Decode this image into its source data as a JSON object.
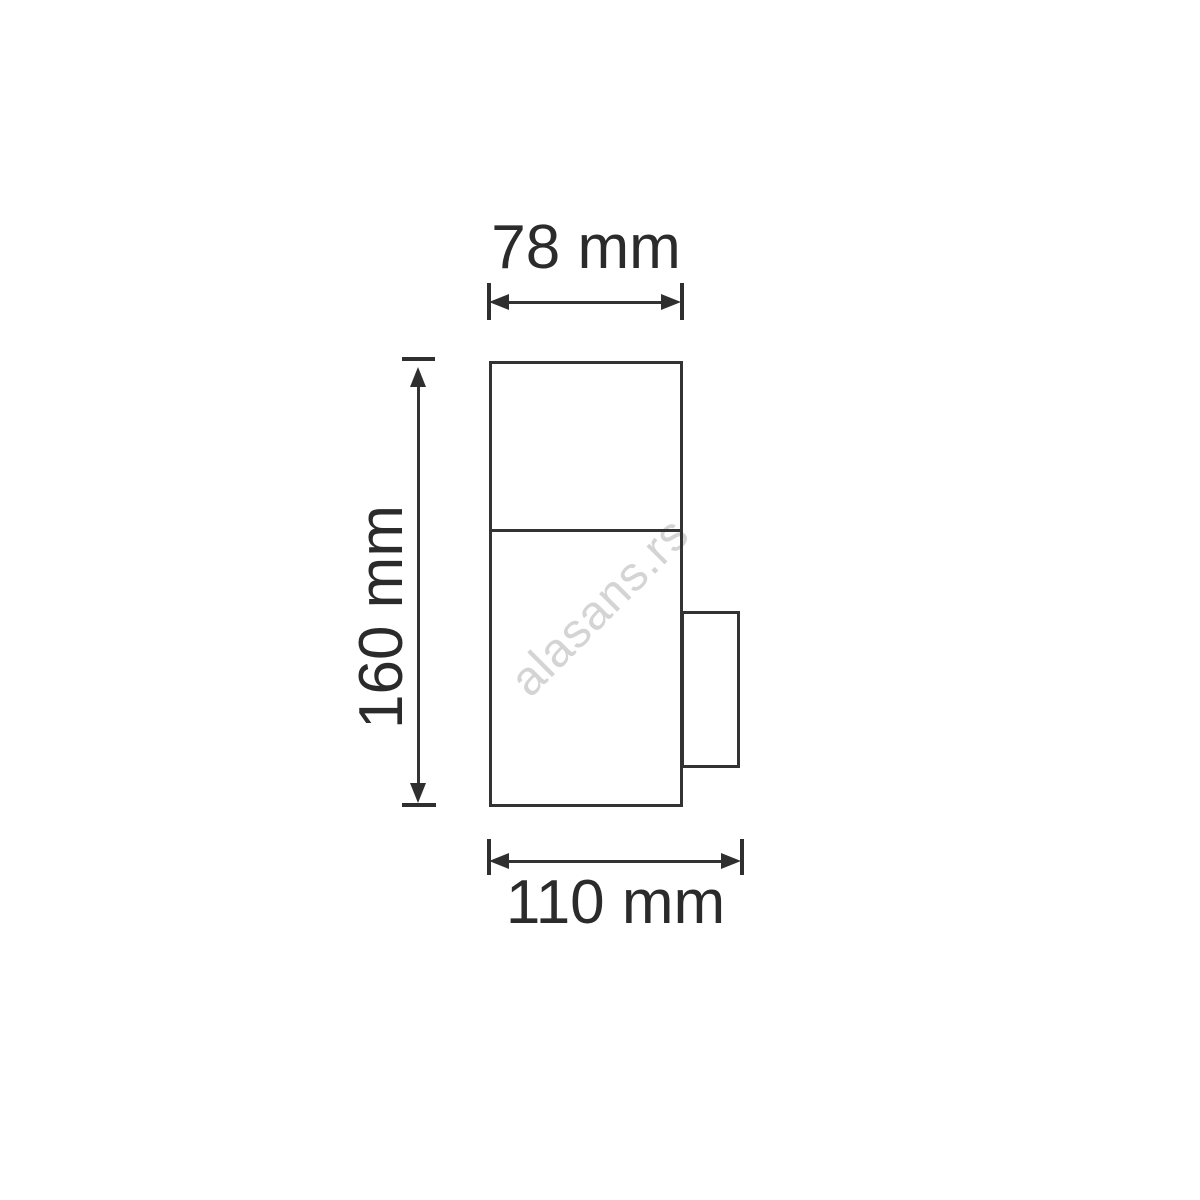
{
  "page": {
    "background": "#ffffff"
  },
  "watermark": {
    "text": "alasans.rs",
    "color": "#d4d4d4"
  },
  "drawing": {
    "line_color": "#333333",
    "text_color": "#2b2b2b",
    "unit": "mm",
    "dimensions": {
      "top_width": {
        "value": 78,
        "unit": "mm",
        "label": "78 mm"
      },
      "height": {
        "value": 160,
        "unit": "mm",
        "label": "160 mm"
      },
      "bottom_width": {
        "value": 110,
        "unit": "mm",
        "label": "110 mm"
      }
    }
  }
}
